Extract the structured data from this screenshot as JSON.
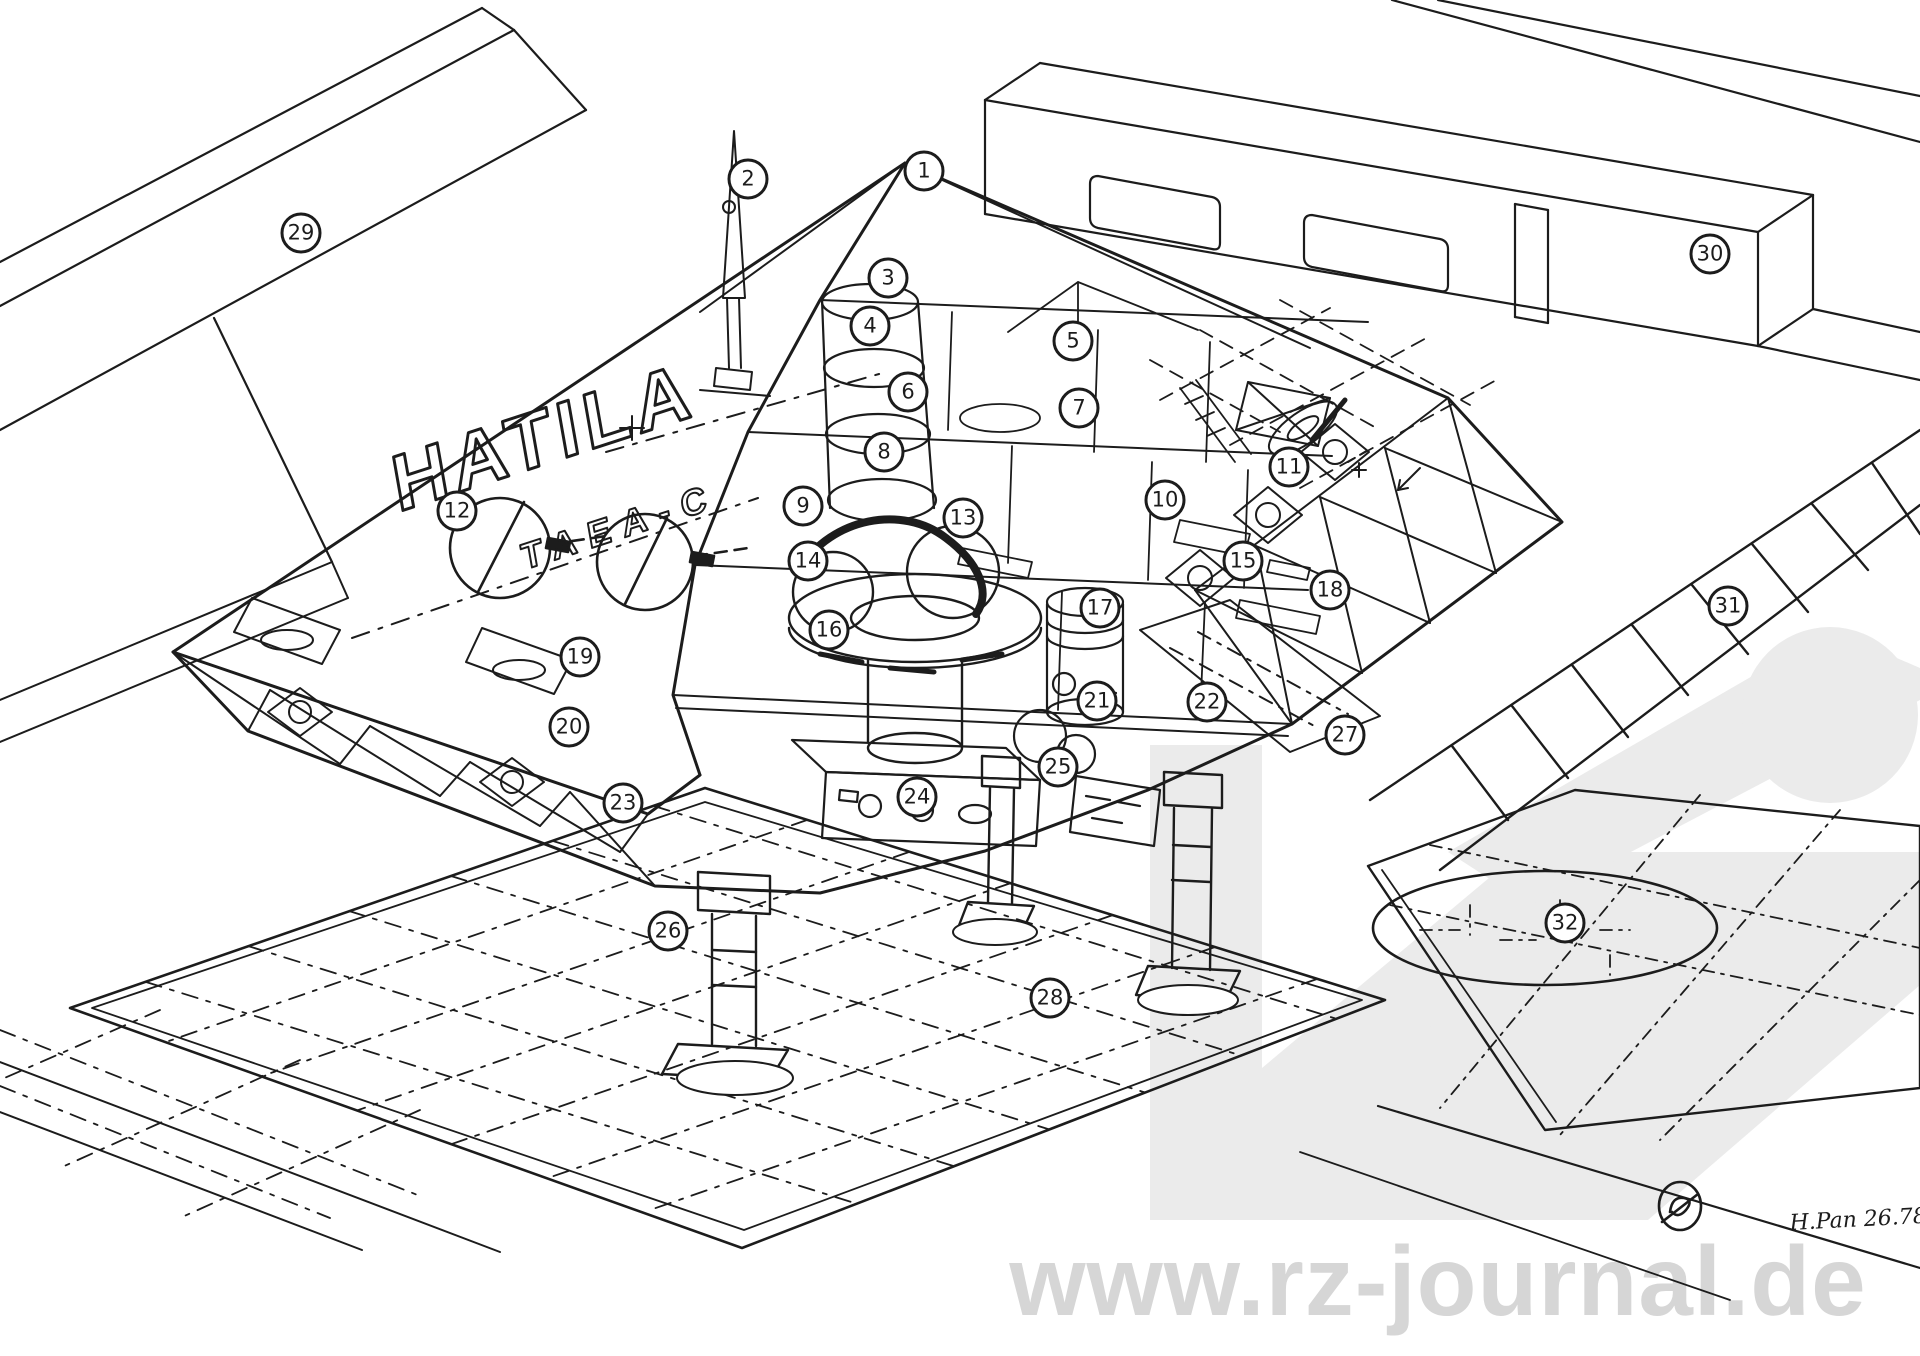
{
  "page": {
    "paper_color": "#ffffff",
    "ink_color": "#1c1c1c",
    "description": "black-and-white cutaway technical illustration of a disc spacecraft standing on landing legs over a gridded hangar deck"
  },
  "watermark": {
    "site_text": "www.rz-journal.de",
    "text_color": "#d6d6d6",
    "logo_color": "#ebebeb"
  },
  "hull_markings": {
    "primary": "HATILA",
    "secondary": "TAEA-C"
  },
  "signature": {
    "handwritten": "H.Pan 26.78"
  },
  "callouts": [
    {
      "label": "1",
      "x": 924,
      "y": 171
    },
    {
      "label": "2",
      "x": 748,
      "y": 179
    },
    {
      "label": "3",
      "x": 888,
      "y": 278
    },
    {
      "label": "4",
      "x": 870,
      "y": 326
    },
    {
      "label": "5",
      "x": 1073,
      "y": 341
    },
    {
      "label": "6",
      "x": 908,
      "y": 392
    },
    {
      "label": "7",
      "x": 1079,
      "y": 408
    },
    {
      "label": "8",
      "x": 884,
      "y": 452
    },
    {
      "label": "9",
      "x": 803,
      "y": 506
    },
    {
      "label": "10",
      "x": 1165,
      "y": 500
    },
    {
      "label": "11",
      "x": 1289,
      "y": 467
    },
    {
      "label": "12",
      "x": 457,
      "y": 511
    },
    {
      "label": "13",
      "x": 963,
      "y": 518
    },
    {
      "label": "14",
      "x": 808,
      "y": 561
    },
    {
      "label": "15",
      "x": 1243,
      "y": 561
    },
    {
      "label": "16",
      "x": 829,
      "y": 630
    },
    {
      "label": "17",
      "x": 1100,
      "y": 608
    },
    {
      "label": "18",
      "x": 1330,
      "y": 590
    },
    {
      "label": "19",
      "x": 580,
      "y": 657
    },
    {
      "label": "20",
      "x": 569,
      "y": 727
    },
    {
      "label": "21",
      "x": 1097,
      "y": 701
    },
    {
      "label": "22",
      "x": 1207,
      "y": 702
    },
    {
      "label": "23",
      "x": 623,
      "y": 803
    },
    {
      "label": "24",
      "x": 917,
      "y": 797
    },
    {
      "label": "25",
      "x": 1058,
      "y": 767
    },
    {
      "label": "26",
      "x": 668,
      "y": 931
    },
    {
      "label": "27",
      "x": 1345,
      "y": 735
    },
    {
      "label": "28",
      "x": 1050,
      "y": 998
    },
    {
      "label": "29",
      "x": 301,
      "y": 233
    },
    {
      "label": "30",
      "x": 1710,
      "y": 254
    },
    {
      "label": "31",
      "x": 1728,
      "y": 606
    },
    {
      "label": "32",
      "x": 1565,
      "y": 923
    }
  ]
}
